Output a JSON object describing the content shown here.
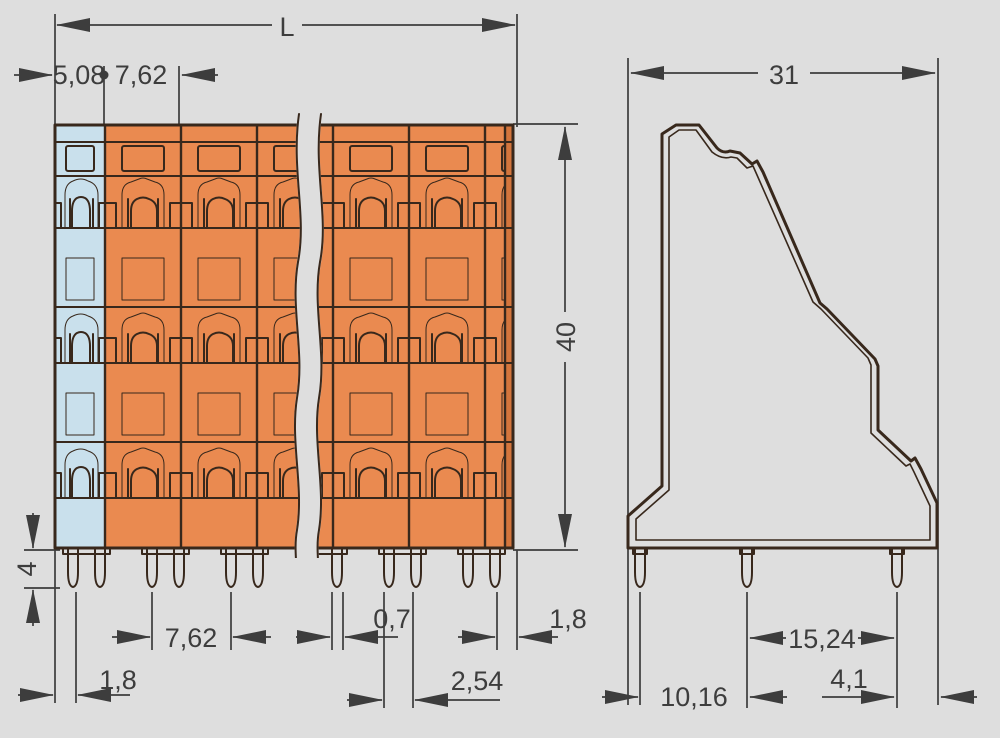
{
  "drawing": {
    "type": "terminal-block-dimensional-drawing",
    "views": {
      "front": "front-view-with-break",
      "side": "side-profile-view"
    },
    "colors": {
      "background": "#dedede",
      "housing": "#ea8a50",
      "housing_shadow": "#d4753c",
      "marker_strip": "#c9e0ec",
      "clamp_port": "#f6c28e",
      "pin": "#f2bf8f",
      "outline": "#38281c",
      "dimension": "#3d3d3d"
    },
    "front_view": {
      "dim_total_length": "L",
      "dim_marker_pitch": "5,08",
      "dim_pole_pitch": "7,62",
      "dim_height": "40",
      "dim_pin_length": "4",
      "dim_pole_pitch_bottom": "7,62",
      "dim_pin_offset_left": "1,8",
      "dim_pin_width": "0,7",
      "dim_pin_gap": "2,54",
      "dim_pin_offset_right": "1,8"
    },
    "side_view": {
      "dim_depth": "31",
      "dim_pin_spacing_rear": "15,24",
      "dim_pin_edge_offset": "4,1",
      "dim_pin_spacing_front": "10,16"
    }
  }
}
